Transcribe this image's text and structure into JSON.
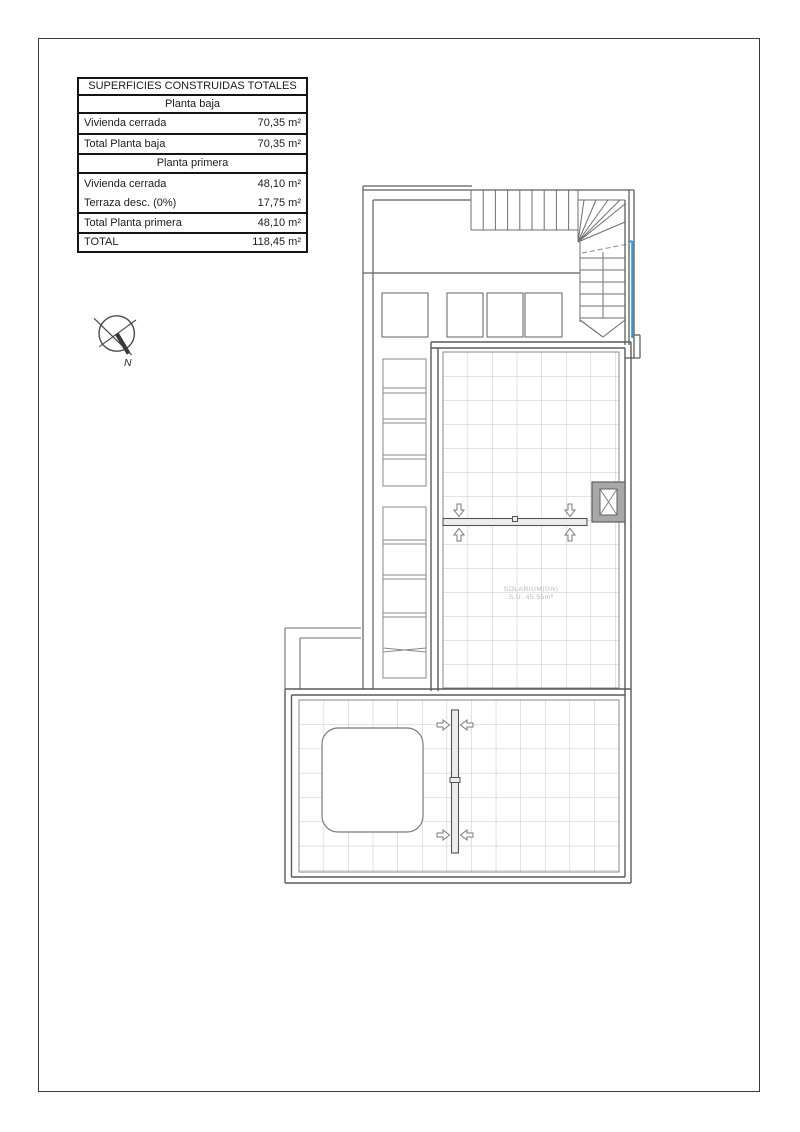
{
  "table": {
    "title": "SUPERFICIES CONSTRUIDAS TOTALES",
    "rows": [
      {
        "label": "Planta baja",
        "value": ""
      },
      {
        "label": "Vivienda cerrada",
        "value": "70,35 m²"
      },
      {
        "label": "Total Planta baja",
        "value": "70,35 m²"
      },
      {
        "label": "Planta primera",
        "value": ""
      },
      {
        "label": "Vivienda cerrada",
        "value": "48,10 m²"
      },
      {
        "label": "Terraza desc. (0%)",
        "value": "17,75 m²"
      },
      {
        "label": "Total Planta primera",
        "value": "48,10 m²"
      },
      {
        "label": "TOTAL",
        "value": "118,45 m²"
      }
    ]
  },
  "compass": {
    "north_label": "N"
  },
  "plan": {
    "solarium_title": "SOLARIUM(0%)",
    "solarium_area": "S.U. 45.55m²"
  },
  "colors": {
    "railing_blue": "#4596C8",
    "wall_gray": "#5f5f5f",
    "grid_gray": "#b5b5b5"
  }
}
